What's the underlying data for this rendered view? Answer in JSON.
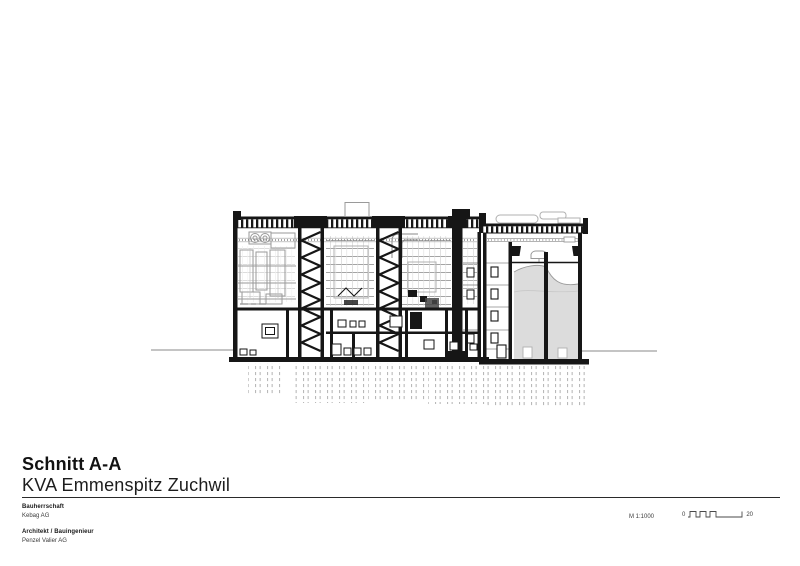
{
  "title_block": {
    "title": "Schnitt A-A",
    "subtitle": "KVA Emmenspitz Zuchwil"
  },
  "project_info": [
    {
      "label": "Bauherrschaft",
      "value": "Kebag AG"
    },
    {
      "label": "Architekt / Bauingenieur",
      "value": "Penzel Valier AG"
    }
  ],
  "scale": {
    "text": "M 1:1000",
    "bar_start": "0",
    "bar_end": "20"
  },
  "colors": {
    "ink": "#161616",
    "light_line": "#9a9a9a",
    "bunker_fill": "#dcdcdc"
  }
}
